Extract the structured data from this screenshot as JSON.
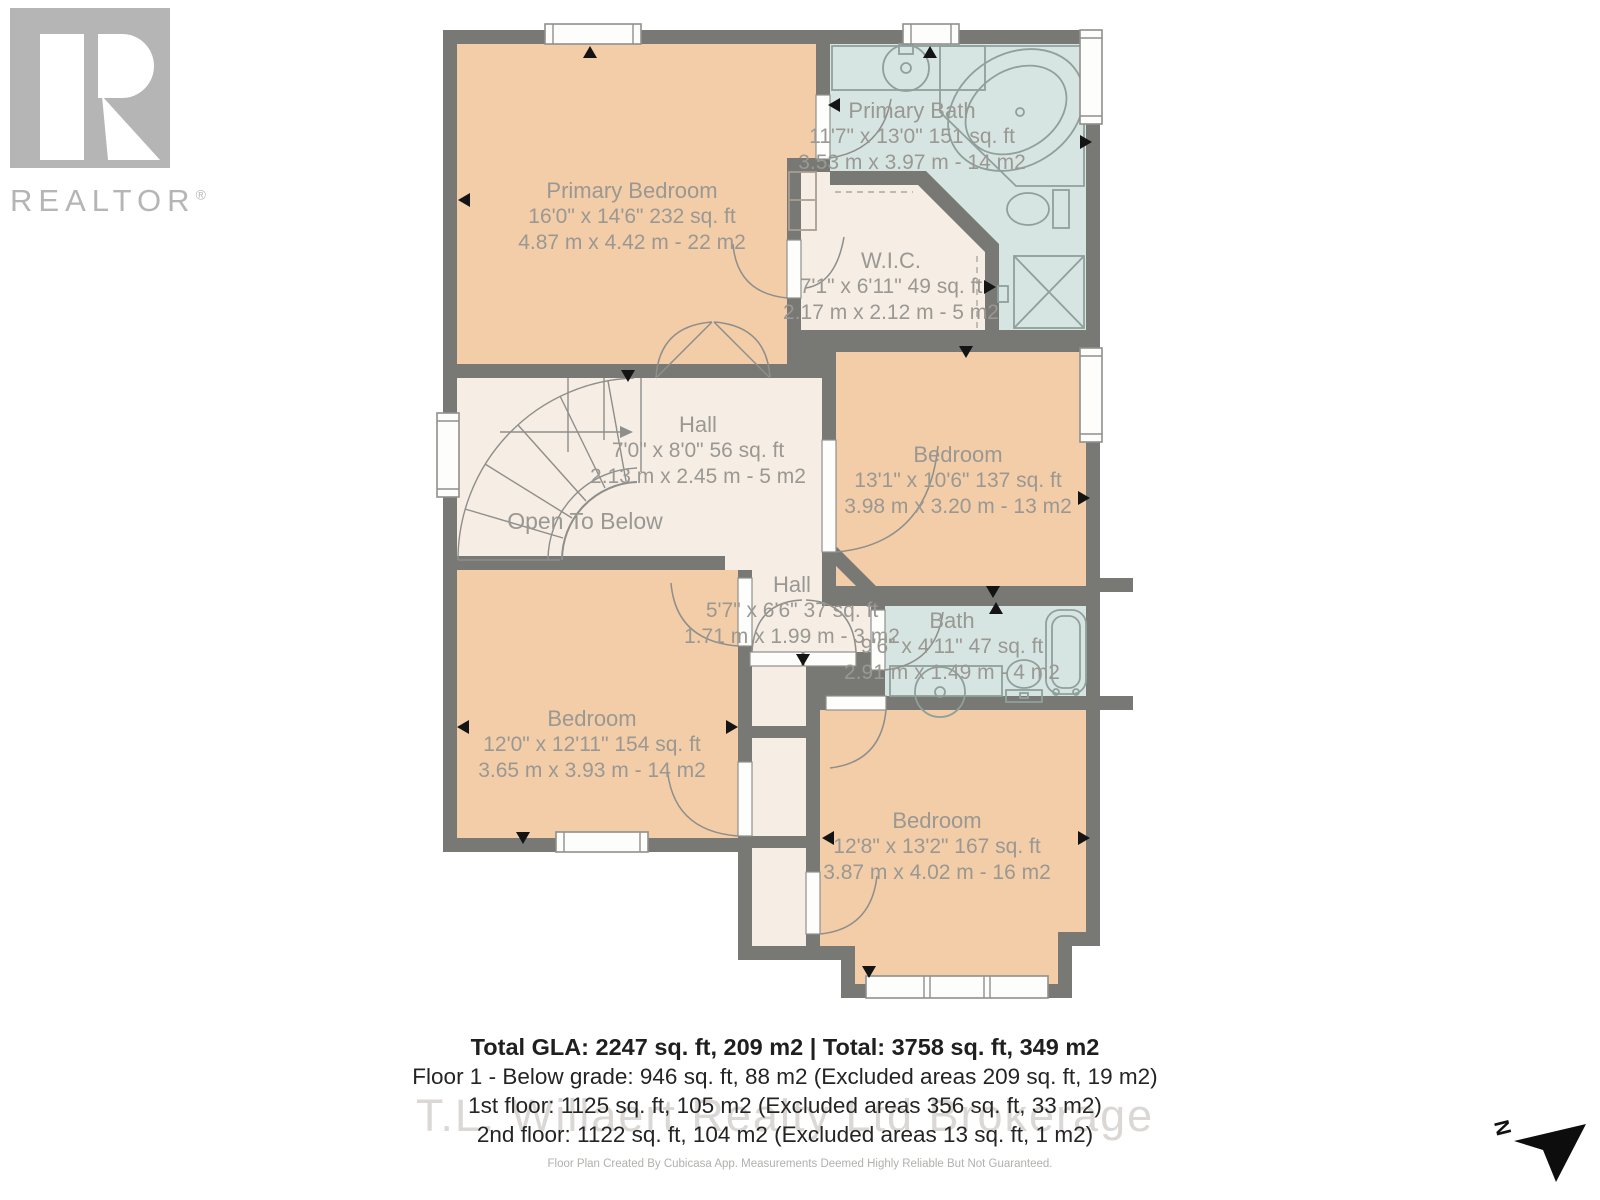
{
  "branding": {
    "realtor_text": "REALTOR",
    "reg_mark": "®"
  },
  "rooms": [
    {
      "id": "primary-bedroom",
      "name": "Primary Bedroom",
      "dim_ft": "16'0\" x 14'6\" 232 sq. ft",
      "dim_m": "4.87 m x 4.42 m - 22 m2"
    },
    {
      "id": "primary-bath",
      "name": "Primary Bath",
      "dim_ft": "11'7\" x 13'0\" 151 sq. ft",
      "dim_m": "3.53 m x 3.97 m - 14 m2"
    },
    {
      "id": "wic",
      "name": "W.I.C.",
      "dim_ft": "7'1\" x 6'11\" 49 sq. ft",
      "dim_m": "2.17 m x 2.12 m - 5 m2"
    },
    {
      "id": "hall-upper",
      "name": "Hall",
      "dim_ft": "7'0\" x 8'0\" 56 sq. ft",
      "dim_m": "2.13 m x 2.45 m - 5 m2"
    },
    {
      "id": "bedroom-right",
      "name": "Bedroom",
      "dim_ft": "13'1\" x 10'6\" 137 sq. ft",
      "dim_m": "3.98 m x 3.20 m - 13 m2"
    },
    {
      "id": "hall-lower",
      "name": "Hall",
      "dim_ft": "5'7\" x 6'6\" 37 sq. ft",
      "dim_m": "1.71 m x 1.99 m - 3 m2"
    },
    {
      "id": "bath",
      "name": "Bath",
      "dim_ft": "9'6\" x 4'11\" 47 sq. ft",
      "dim_m": "2.91 m x 1.49 m - 4 m2"
    },
    {
      "id": "bedroom-left",
      "name": "Bedroom",
      "dim_ft": "12'0\" x 12'11\" 154 sq. ft",
      "dim_m": "3.65 m x 3.93 m - 14 m2"
    },
    {
      "id": "bedroom-bottom",
      "name": "Bedroom",
      "dim_ft": "12'8\" x 13'2\" 167 sq. ft",
      "dim_m": "3.87 m x 4.02 m - 16 m2"
    }
  ],
  "annotations": {
    "open_to_below": "Open To Below",
    "north_label": "N"
  },
  "summary": {
    "total": "Total GLA: 2247 sq. ft, 209 m2 | Total: 3758 sq. ft, 349 m2",
    "floor1": "Floor 1 - Below grade: 946 sq. ft, 88 m2 (Excluded areas 209 sq. ft, 19 m2)",
    "floor2": "1st floor: 1125 sq. ft, 105 m2 (Excluded areas 356 sq. ft, 33 m2)",
    "floor3": "2nd floor: 1122 sq. ft, 104 m2 (Excluded areas 13 sq. ft, 1 m2)"
  },
  "watermark": "T.L. Willaert Realty Ltd Brokerage",
  "footer": "Floor Plan Created By Cubicasa App. Measurements Deemed Highly Reliable But Not Guaranteed.",
  "colors": {
    "wall": "#787875",
    "peach": "#f2cda8",
    "teal": "#d7e5e2",
    "cream": "#f6ede5",
    "label": "#9a9893",
    "fixture": "#8fa09b",
    "furniture": "#a89e92",
    "window_stroke": "#8f8f8c",
    "door_stroke": "#8e8e8b",
    "dark_text": "#1f1f1f",
    "muted": "#b2b0ad",
    "watermark": "#d4d1ce",
    "logo_gray": "#b5b5b5",
    "arrow_black": "#141414"
  }
}
